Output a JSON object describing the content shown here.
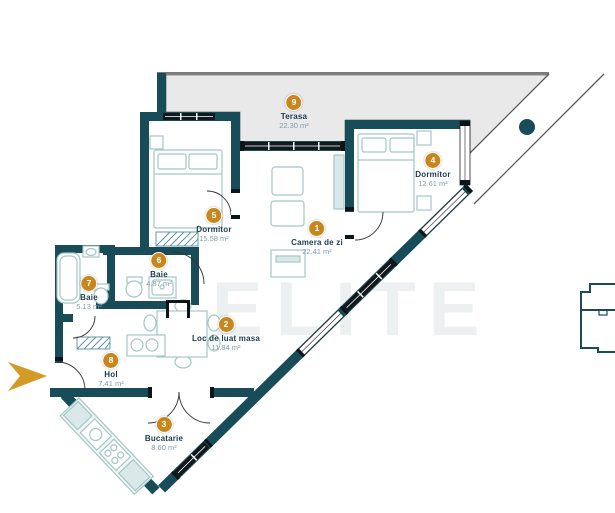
{
  "plan": {
    "watermark": "ELITE",
    "rooms": [
      {
        "number": "1",
        "name": "Camera de zi",
        "area": "22.41 m²"
      },
      {
        "number": "2",
        "name": "Loc de luat masa",
        "area": "11.84 m²"
      },
      {
        "number": "3",
        "name": "Bucatarie",
        "area": "8.60 m²"
      },
      {
        "number": "4",
        "name": "Dormitor",
        "area": "12.61 m²"
      },
      {
        "number": "5",
        "name": "Dormitor",
        "area": "15.58 m²"
      },
      {
        "number": "6",
        "name": "Baie",
        "area": "4.87 m²"
      },
      {
        "number": "7",
        "name": "Baie",
        "area": "5.13 m²"
      },
      {
        "number": "8",
        "name": "Hol",
        "area": "7.41 m²"
      },
      {
        "number": "9",
        "name": "Terasa",
        "area": "22.30 m²"
      }
    ],
    "colors": {
      "wall": "#174c58",
      "badge_gold": "#c8871e",
      "room_name": "#1c3b50",
      "room_area": "#7e9dab",
      "terrace_floor": "#e9e9e9",
      "furniture_line": "#a3c6c6",
      "entrance_arrow": "#d39a26",
      "glass_dark": "#11191d"
    }
  }
}
